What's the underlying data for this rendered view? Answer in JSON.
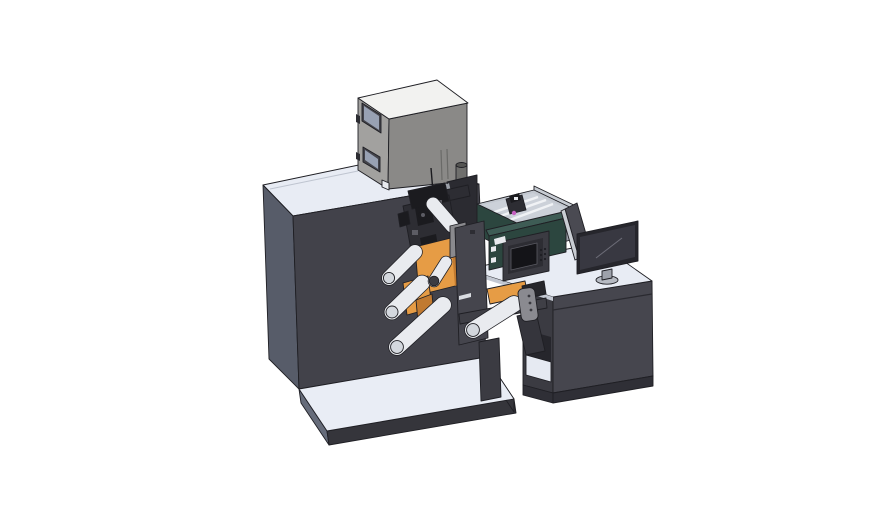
{
  "scene": {
    "background": "#ffffff"
  },
  "colors": {
    "bg": "#ffffff",
    "outline": "#1f1f24",
    "edge_light": "#bfc5d0",
    "cabinet_front": "#42424a",
    "cabinet_side": "#575c69",
    "cabinet_top": "#e8ecf4",
    "base_top": "#e9edf5",
    "base_front": "#35353b",
    "base_side": "#666c7a",
    "box_top": "#f2f2f0",
    "box_left": "#a2a19f",
    "box_front": "#8a8987",
    "box_slot": "#6a6a68",
    "window_frame": "#44444b",
    "window_glass": "#98a1b3",
    "vent_body": "#6f6f6d",
    "vent_cap": "#555553",
    "stand_dark": "#2b2b31",
    "stand_bevel": "#9ba0a8",
    "sticker_white": "#e8eaee",
    "mech_dark": "#1b1b1f",
    "mech_mid": "#2d2d33",
    "mech_light": "#5c5c64",
    "roll_orange": "#e69c45",
    "roll_orange_dark": "#c17a30",
    "roller_body": "#e9ebef",
    "roller_cap": "#d4d8de",
    "roller_cap_dark": "#3c3c42",
    "plate_front": "#45454d",
    "plate_step": "#8a8a8e",
    "label_light": "#d9dce1",
    "beam_dark": "#3f3f46",
    "leg_dark": "#3b3b42",
    "sensor_face": "#8a8a90",
    "sensor_dot": "#3a3a40",
    "arm_dark": "#35353c",
    "connector_dark": "#26262b",
    "teal_front": "#2c463f",
    "teal_top": "#3e5c55",
    "panel_face": "#3b3b42",
    "panel_bezel": "#2d2d33",
    "panel_screen": "#141418",
    "panel_screen_edge": "#5a5a62",
    "panel_dot": "#1e1e23",
    "tray_wall": "#c3c8d0",
    "tray_wall_dark": "#9ba0a9",
    "tray_inner": "#ccd1d9",
    "tray_rail": "#f0f2f5",
    "tray_back": "#c7ccd3",
    "magenta": "#c55fc0",
    "desk_front": "#46464e",
    "desk_side": "#3b3b42",
    "desk_top": "#e8ecf4",
    "desk_base": "#2f2f36",
    "desk_seam": "#2a2a30",
    "shelf_floor": "#e6eaf2",
    "shelf_shadow": "#26262c",
    "divider_face": "#4a4a52",
    "divider_edge": "#c9cdd3",
    "monitor_frame": "#26262c",
    "monitor_screen": "#383841",
    "monitor_reflect": "#6d6d78",
    "monitor_neck": "#9ea2ab",
    "monitor_base": "#b6bac2",
    "seam_light": "#c3c8d2"
  }
}
